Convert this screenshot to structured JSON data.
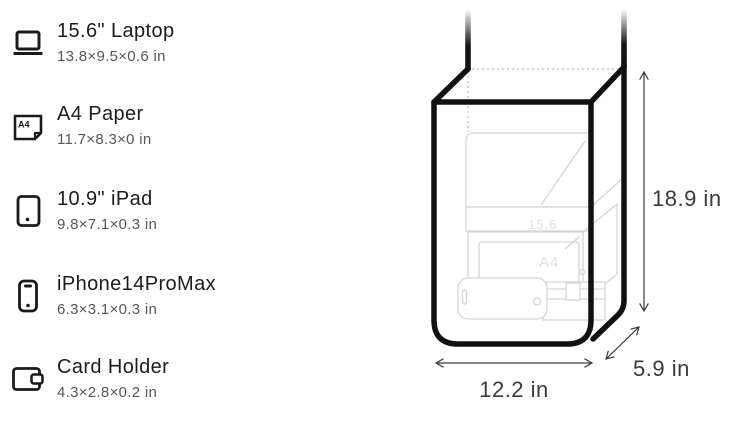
{
  "items": [
    {
      "title": "15.6\" Laptop",
      "dims": "13.8×9.5×0.6 in",
      "icon": "laptop-icon"
    },
    {
      "title": "A4 Paper",
      "dims": "11.7×8.3×0 in",
      "icon": "a4-paper-icon",
      "icon_label": "A4"
    },
    {
      "title": "10.9\" iPad",
      "dims": "9.8×7.1×0.3 in",
      "icon": "ipad-icon"
    },
    {
      "title": "iPhone14ProMax",
      "dims": "6.3×3.1×0.3 in",
      "icon": "iphone-icon"
    },
    {
      "title": "Card Holder",
      "dims": "4.3×2.8×0.2 in",
      "icon": "wallet-icon"
    }
  ],
  "bag": {
    "height_label": "18.9 in",
    "width_label": "12.2 in",
    "depth_label": "5.9 in",
    "ghost_laptop_label": "15.6",
    "ghost_paper_label": "A4"
  },
  "colors": {
    "outline": "#111111",
    "ghost_line": "#d5d5d5",
    "dotted_line": "#c6c6c6",
    "dimension_text": "#3a3a3c",
    "title_text": "#1c1c1e",
    "subtitle_text": "#57575a"
  }
}
